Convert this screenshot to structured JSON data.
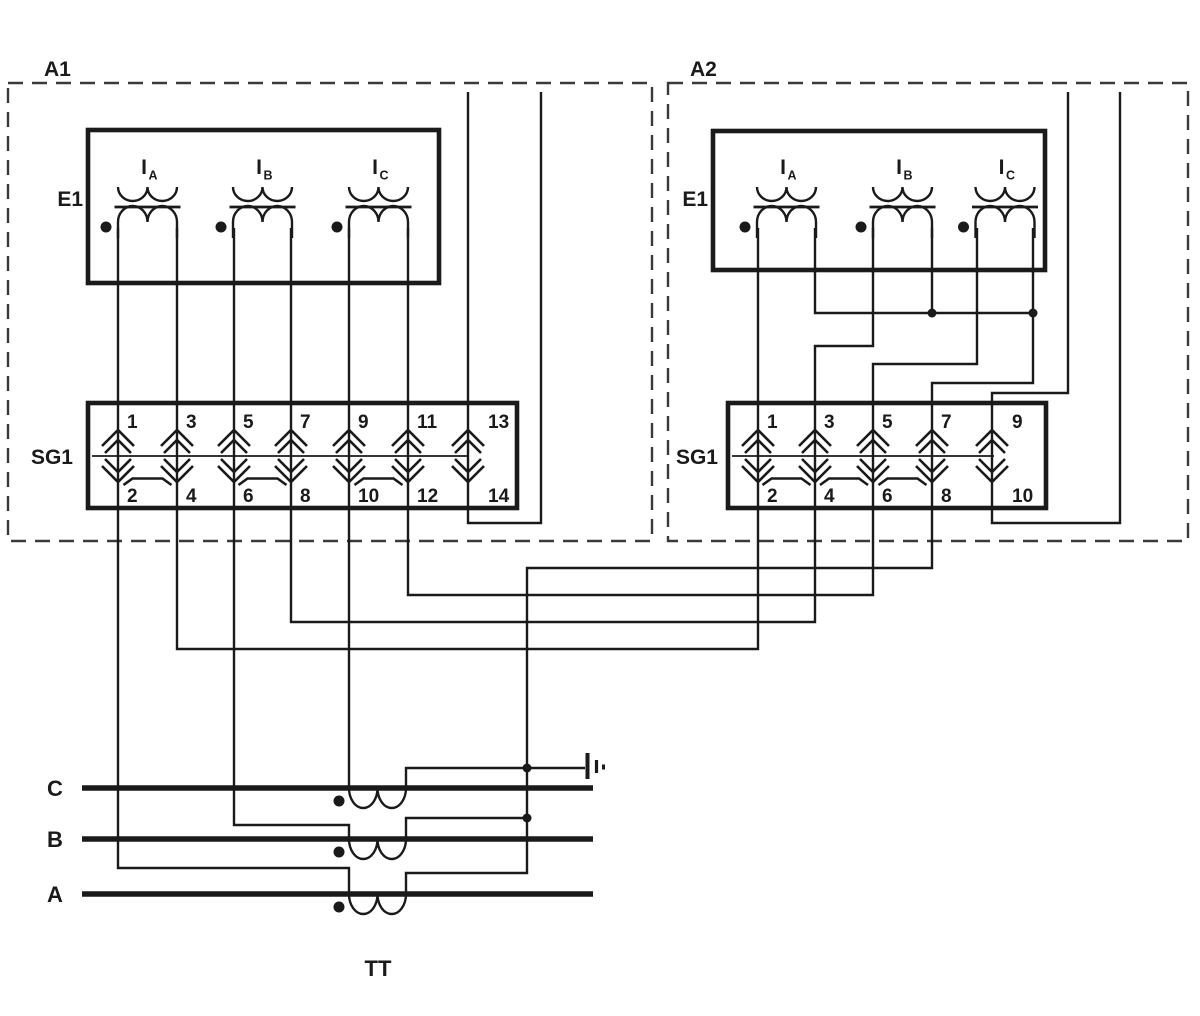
{
  "a1": {
    "label": "A1",
    "meter": {
      "label": "E1",
      "coil_prefix": "I",
      "coil_subs": [
        "A",
        "B",
        "C"
      ]
    },
    "sg": {
      "label": "SG1",
      "top": [
        "1",
        "3",
        "5",
        "7",
        "9",
        "11",
        "13"
      ],
      "bottom": [
        "2",
        "4",
        "6",
        "8",
        "10",
        "12",
        "14"
      ]
    }
  },
  "a2": {
    "label": "A2",
    "meter": {
      "label": "E1",
      "coil_prefix": "I",
      "coil_subs": [
        "A",
        "B",
        "C"
      ]
    },
    "sg": {
      "label": "SG1",
      "top": [
        "1",
        "3",
        "5",
        "7",
        "9"
      ],
      "bottom": [
        "2",
        "4",
        "6",
        "8",
        "10"
      ]
    }
  },
  "tt": {
    "label": "TT",
    "phases": [
      "C",
      "B",
      "A"
    ]
  },
  "colors": {
    "ink": "#1a1a1a",
    "paper": "#ffffff"
  }
}
